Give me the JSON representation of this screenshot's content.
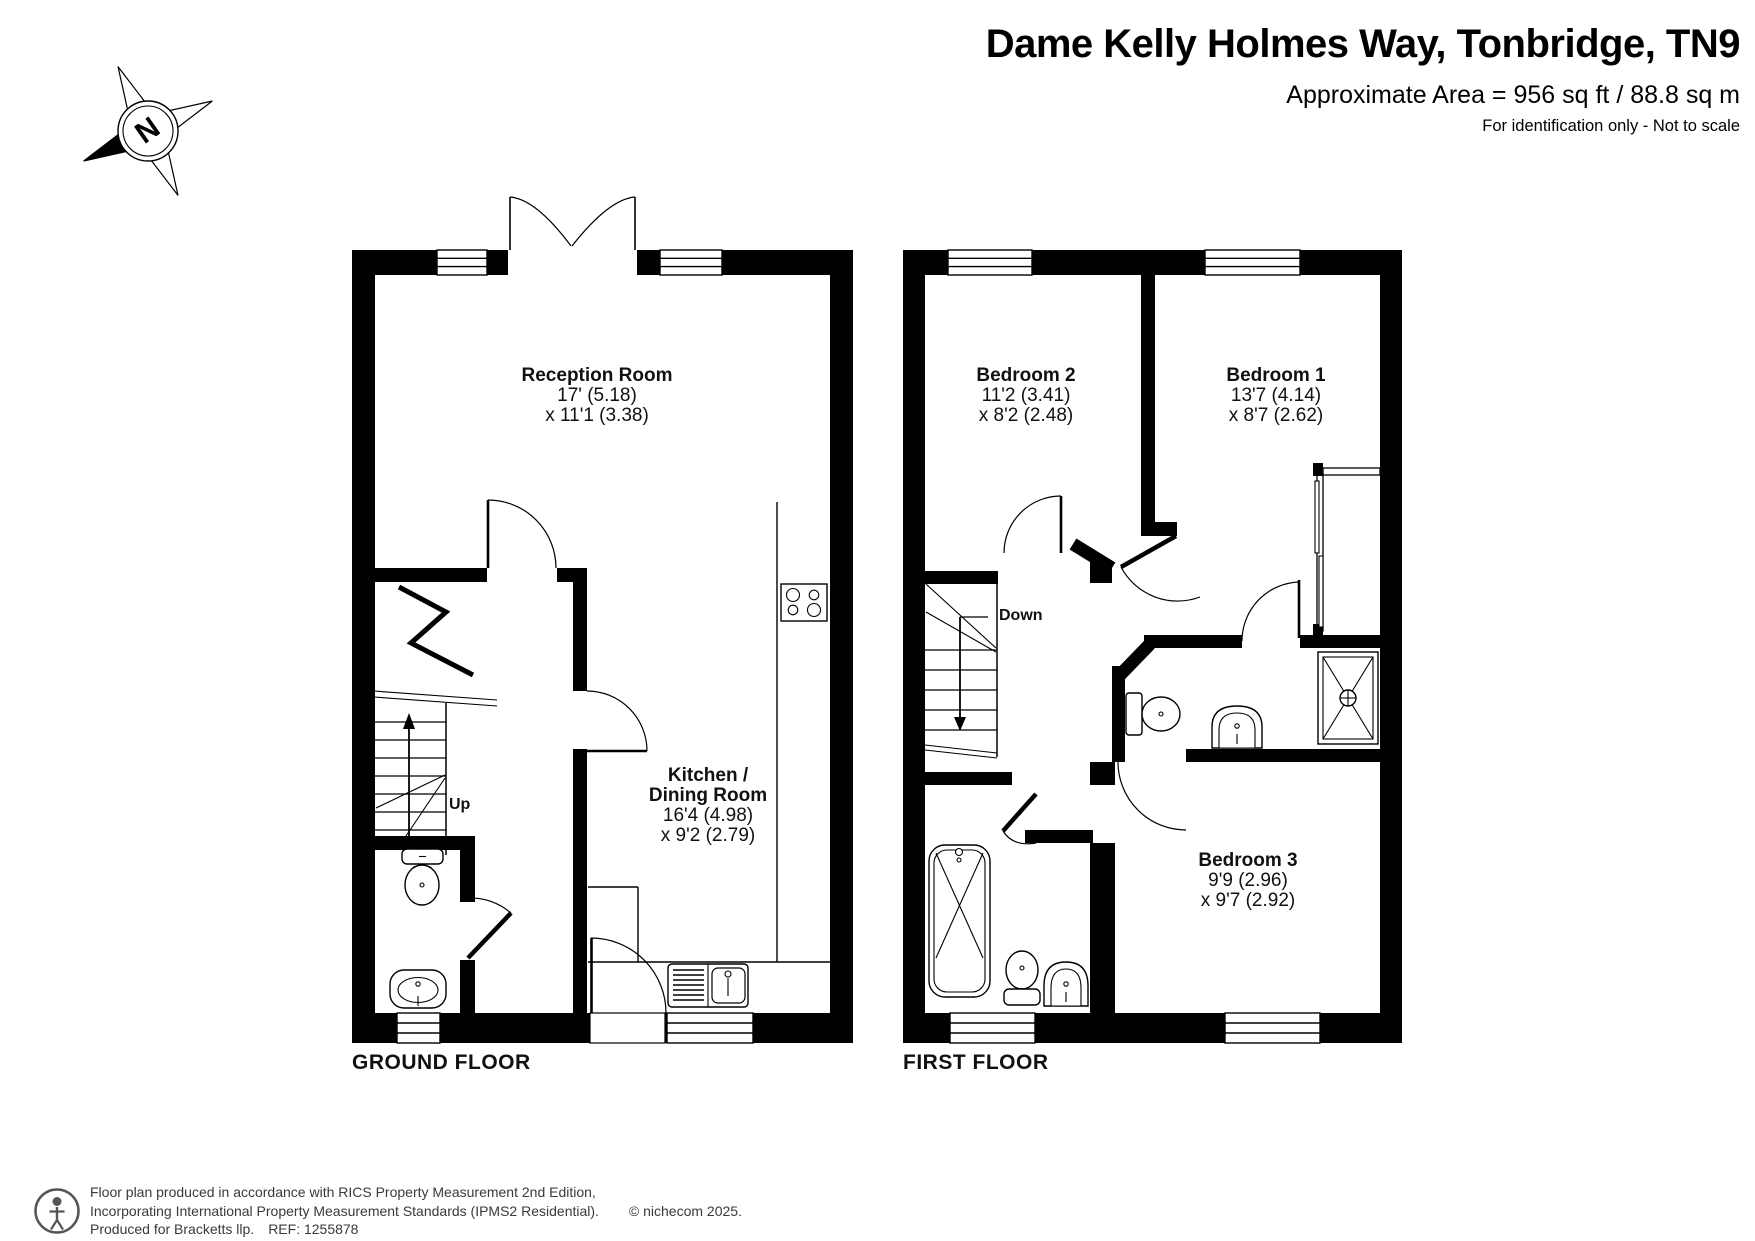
{
  "header": {
    "title": "Dame Kelly Holmes Way, Tonbridge, TN9",
    "area": "Approximate Area = 956 sq ft / 88.8 sq m",
    "note": "For identification only - Not to scale"
  },
  "compass": {
    "north": "N"
  },
  "rooms": {
    "reception": {
      "name": "Reception Room",
      "dim1": "17' (5.18)",
      "dim2": "x 11'1 (3.38)"
    },
    "kitchen": {
      "name1": "Kitchen /",
      "name2": "Dining Room",
      "dim1": "16'4 (4.98)",
      "dim2": "x 9'2 (2.79)"
    },
    "bedroom2": {
      "name": "Bedroom 2",
      "dim1": "11'2 (3.41)",
      "dim2": "x 8'2 (2.48)"
    },
    "bedroom1": {
      "name": "Bedroom 1",
      "dim1": "13'7 (4.14)",
      "dim2": "x 8'7 (2.62)"
    },
    "bedroom3": {
      "name": "Bedroom 3",
      "dim1": "9'9 (2.96)",
      "dim2": "x 9'7 (2.92)"
    }
  },
  "stairs": {
    "up": "Up",
    "down": "Down"
  },
  "floor_labels": {
    "ground": "GROUND FLOOR",
    "first": "FIRST FLOOR"
  },
  "footer": {
    "line1": "Floor plan produced in accordance with RICS Property Measurement 2nd Edition,",
    "line2": "Incorporating International Property Measurement Standards (IPMS2 Residential).",
    "copyright": "© nichecom 2025.",
    "line3a": "Produced for Bracketts llp.",
    "line3b": "REF: 1255878"
  }
}
